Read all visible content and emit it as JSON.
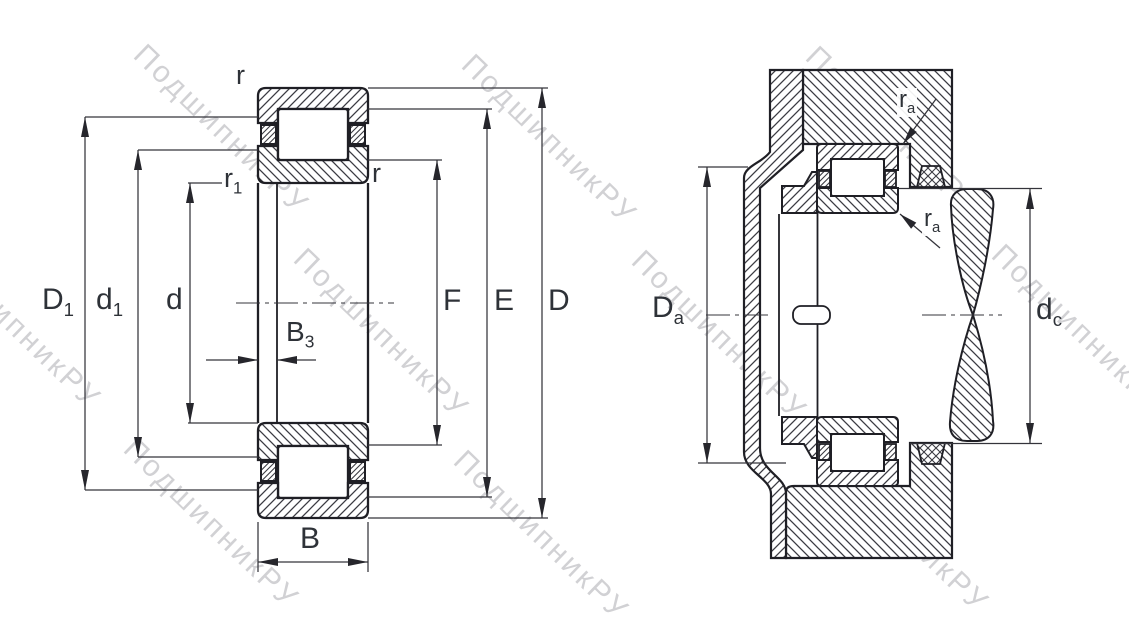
{
  "watermark": {
    "text": "ПодшипникРУ"
  },
  "colors": {
    "line": "#1f1f25",
    "thin_line": "#34343b",
    "hatch": "#3b3b42",
    "label_text": "#2e3238",
    "watermark": "#adadb2",
    "background": "#ffffff"
  },
  "left_view": {
    "labels": {
      "r_top": "r",
      "r1": {
        "base": "r",
        "sub": "1"
      },
      "r_mid": "r",
      "D1": {
        "base": "D",
        "sub": "1"
      },
      "d1": {
        "base": "d",
        "sub": "1"
      },
      "d": "d",
      "B3": {
        "base": "B",
        "sub": "3"
      },
      "F": "F",
      "E": "E",
      "D": "D",
      "B": "B"
    }
  },
  "right_view": {
    "labels": {
      "ra_upper": {
        "base": "r",
        "sub": "a"
      },
      "ra_lower": {
        "base": "r",
        "sub": "a"
      },
      "Da": {
        "base": "D",
        "sub": "a"
      },
      "dc": {
        "base": "d",
        "sub": "c"
      }
    }
  }
}
